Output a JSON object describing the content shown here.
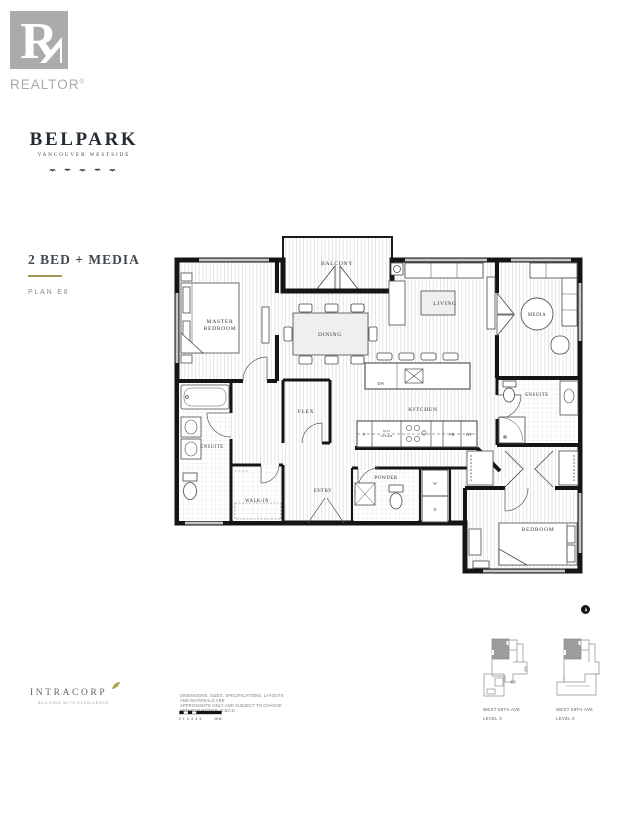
{
  "branding": {
    "realtor_r": "R",
    "realtor_wordmark": "REALTOR",
    "registered_mark": "®",
    "project_name": "BELPARK",
    "project_tagline": "VANCOUVER WESTSIDE"
  },
  "plan_header": {
    "title": "2 BED + MEDIA",
    "plan_code": "PLAN E8"
  },
  "floorplan": {
    "labels": {
      "balcony": "BALCONY",
      "master_line1": "MASTER",
      "master_line2": "BEDROOM",
      "dining": "DINING",
      "living": "LIVING",
      "media": "MEDIA",
      "flex": "FLEX",
      "kitchen": "KITCHEN",
      "ensuite_left": "ENSUITE",
      "ensuite_right": "ENSUITE",
      "walk_in": "WALK-IN",
      "entry": "ENTRY",
      "powder": "POWDER",
      "bedroom": "BEDROOM"
    },
    "appliances": {
      "dishwasher": "DW",
      "pantry": "P",
      "wall_oven_line1": "W/O",
      "wall_oven_line2": "STEAM",
      "fridge": "FR",
      "wine_fridge": "WF",
      "washer": "W",
      "dryer": "D"
    }
  },
  "keyplans": [
    {
      "street": "WEST 59TH AVE",
      "level": "LEVEL 3"
    },
    {
      "street": "WEST 59TH AVE",
      "level": "LEVEL 6"
    }
  ],
  "footer": {
    "developer": "INTRACORP",
    "developer_tagline": "BUILDING WITH EXCELLENCE",
    "disclaimer_line1": "DIMENSIONS, SIZES, SPECIFICATIONS, LAYOUTS AND MATERIALS ARE",
    "disclaimer_line2": "APPROXIMATE ONLY AND SUBJECT TO CHANGE WITHOUT NOTICE. E.&O.E.",
    "scale_ticks": [
      "0",
      "1",
      "2",
      "3",
      "4",
      "5"
    ],
    "scale_end": "10 M"
  },
  "colors": {
    "accent_gold": "#a3965a",
    "wall_black": "#151515",
    "logo_gray": "#a9a9a9"
  }
}
